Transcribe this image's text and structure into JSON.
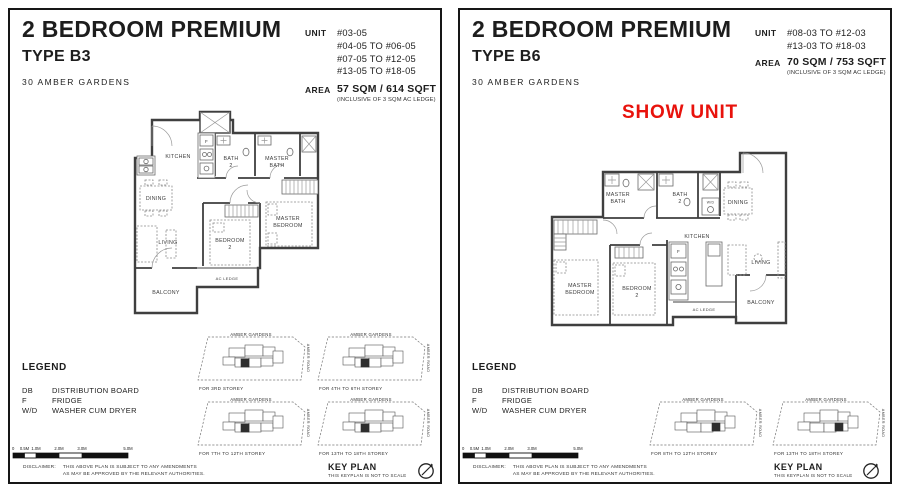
{
  "colors": {
    "accent_red": "#e8120c",
    "ink": "#1d1d1d",
    "plan_line": "#3f3f3f"
  },
  "keyplan": {
    "title": "KEY PLAN",
    "note": "THIS KEYPLAN IS NOT TO SCALE",
    "area_label": "AMBER GARDENS",
    "road_label": "AMBER ROAD"
  },
  "legend": {
    "title": "LEGEND",
    "rows": [
      {
        "abbr": "DB",
        "desc": "DISTRIBUTION BOARD"
      },
      {
        "abbr": "F",
        "desc": "FRIDGE"
      },
      {
        "abbr": "W/D",
        "desc": "WASHER CUM DRYER"
      }
    ]
  },
  "scale": {
    "labels": [
      "0",
      "0.5M",
      "1.0M",
      "2.0M",
      "3.0M",
      "5.0M"
    ]
  },
  "disclaimer": {
    "label": "DISCLAIMER:",
    "line1": "THIS ABOVE PLAN IS SUBJECT TO ANY AMENDMENTS",
    "line2": "AS MAY BE APPROVED BY THE RELEVANT AUTHORITIES."
  },
  "panel_b3": {
    "title": "2 BEDROOM PREMIUM",
    "type": "TYPE B3",
    "project": "30 AMBER GARDENS",
    "unit_label": "UNIT",
    "units": [
      "#03-05",
      "#04-05 TO #06-05",
      "#07-05 TO #12-05",
      "#13-05 TO #18-05"
    ],
    "area_label": "AREA",
    "area": "57 SQM / 614 SQFT",
    "area_note": "(INCLUSIVE OF 3 SQM AC LEDGE)",
    "storeys": [
      "FOR 3RD STOREY",
      "FOR 4TH TO 6TH STOREY",
      "FOR 7TH TO 12TH STOREY",
      "FOR 13TH TO 18TH STOREY"
    ],
    "rooms": {
      "kitchen": "KITCHEN",
      "bath2a": "BATH",
      "bath2b": "2",
      "mbatha": "MASTER",
      "mbathb": "BATH",
      "dining": "DINING",
      "living": "LIVING",
      "bed2a": "BEDROOM",
      "bed2b": "2",
      "mbeda": "MASTER",
      "mbedb": "BEDROOM",
      "balcony": "BALCONY",
      "acledge": "AC LEDGE",
      "fridge": "F"
    }
  },
  "panel_b6": {
    "title": "2 BEDROOM PREMIUM",
    "type": "TYPE B6",
    "project": "30 AMBER GARDENS",
    "show_unit": "SHOW UNIT",
    "unit_label": "UNIT",
    "units": [
      "#08-03 TO #12-03",
      "#13-03 TO #18-03"
    ],
    "area_label": "AREA",
    "area": "70 SQM / 753 SQFT",
    "area_note": "(INCLUSIVE OF 3 SQM AC LEDGE)",
    "storeys": [
      "FOR 8TH TO 12TH STOREY",
      "FOR 13TH TO 18TH STOREY"
    ],
    "rooms": {
      "kitchen": "KITCHEN",
      "bath2a": "BATH",
      "bath2b": "2",
      "mbatha": "MASTER",
      "mbathb": "BATH",
      "dining": "DINING",
      "living": "LIVING",
      "bed2a": "BEDROOM",
      "bed2b": "2",
      "mbeda": "MASTER",
      "mbedb": "BEDROOM",
      "balcony": "BALCONY",
      "acledge": "AC LEDGE",
      "fridge": "F",
      "wd": "W/D"
    }
  }
}
